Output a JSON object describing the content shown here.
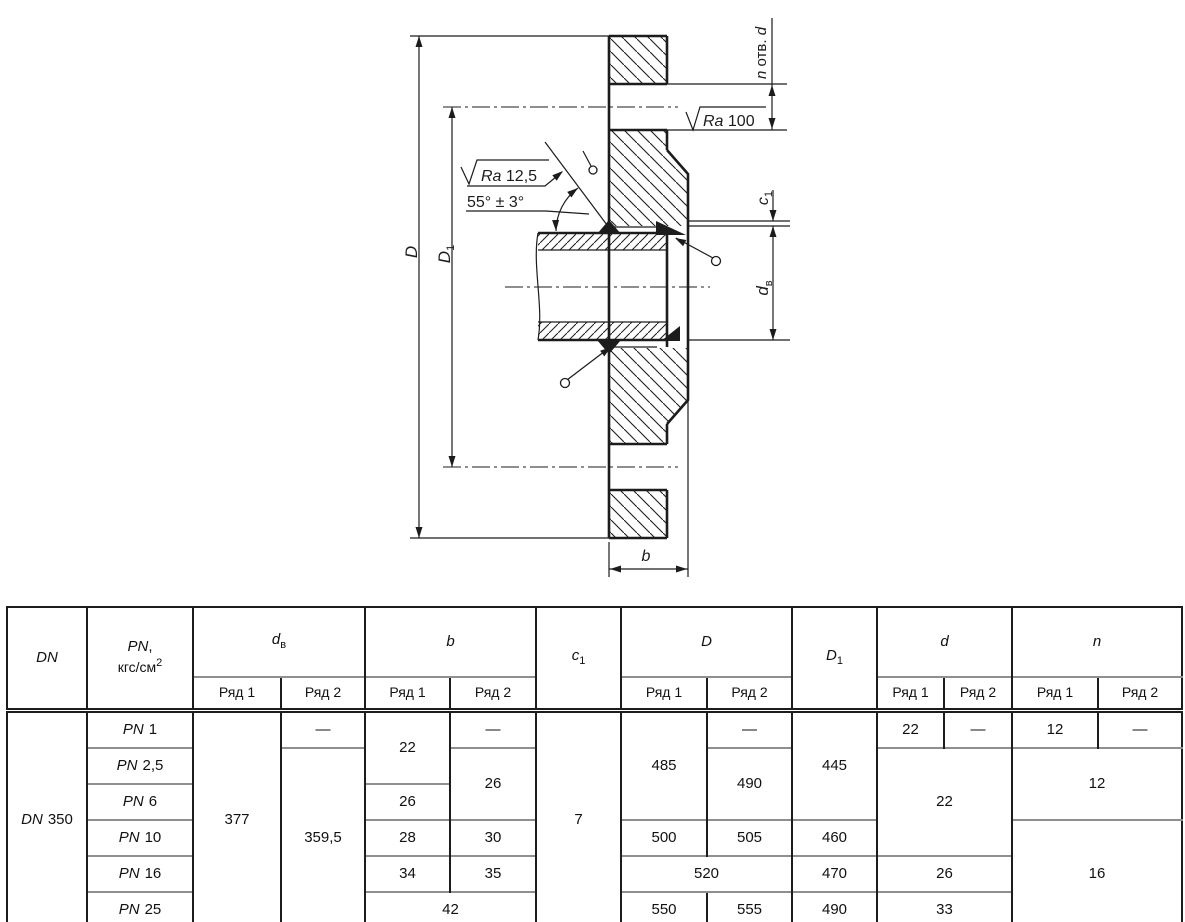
{
  "drawing": {
    "d_outer": "D",
    "d_bolt_circle": {
      "base": "D",
      "sub": "1"
    },
    "holes": {
      "n": "n",
      "text": " отв. ",
      "d": "d"
    },
    "ra_face": {
      "sym": "Ra",
      "val": " 100"
    },
    "ra_bevel": {
      "sym": "Ra",
      "val": " 12,5"
    },
    "bevel_angle": "55° ± 3°",
    "c1": {
      "base": "c",
      "sub": "1"
    },
    "d_inner": {
      "base": "d",
      "sub": "в"
    },
    "b": "b"
  },
  "table": {
    "header": {
      "dn": "DN",
      "pn_sym": "PN",
      "pn_comma": ",",
      "pn_unit": "кгс/см",
      "pn_sup": "2",
      "dv_base": "d",
      "dv_sub": "в",
      "b": "b",
      "c1_base": "c",
      "c1_sub": "1",
      "D": "D",
      "D1_base": "D",
      "D1_sub": "1",
      "d": "d",
      "n": "n",
      "ryad1": "Ряд 1",
      "ryad2": "Ряд 2"
    },
    "dn_value": {
      "sym": "DN",
      "num": "350"
    },
    "pn_rows": [
      {
        "sym": "PN",
        "num": "1"
      },
      {
        "sym": "PN",
        "num": "2,5"
      },
      {
        "sym": "PN",
        "num": "6"
      },
      {
        "sym": "PN",
        "num": "10"
      },
      {
        "sym": "PN",
        "num": "16"
      },
      {
        "sym": "PN",
        "num": "25"
      }
    ],
    "cells": {
      "dv_r1": "377",
      "dv_r2_row1": "—",
      "dv_r2_rows2_6": "359,5",
      "b_r1_rows12": "22",
      "b_r2_row1": "—",
      "b_r2_rows23": "26",
      "b_r1_row3": "26",
      "b_r1_row4": "28",
      "b_r2_row4": "30",
      "b_r1_row5": "34",
      "b_r2_row5": "35",
      "b_row6": "42",
      "c1_all": "7",
      "D_r1_rows123": "485",
      "D_r2_row1": "—",
      "D_r2_rows23": "490",
      "D_r1_row4": "500",
      "D_r2_row4": "505",
      "D_row5": "520",
      "D_r1_row6": "550",
      "D_r2_row6": "555",
      "D1_rows123": "445",
      "D1_row4": "460",
      "D1_row5": "470",
      "D1_row6": "490",
      "d_r1_row1": "22",
      "d_r2_row1": "—",
      "d_rows234": "22",
      "d_row5": "26",
      "d_row6": "33",
      "n_r1_row1": "12",
      "n_r2_row1": "—",
      "n_rows23": "12",
      "n_rows456": "16"
    }
  }
}
